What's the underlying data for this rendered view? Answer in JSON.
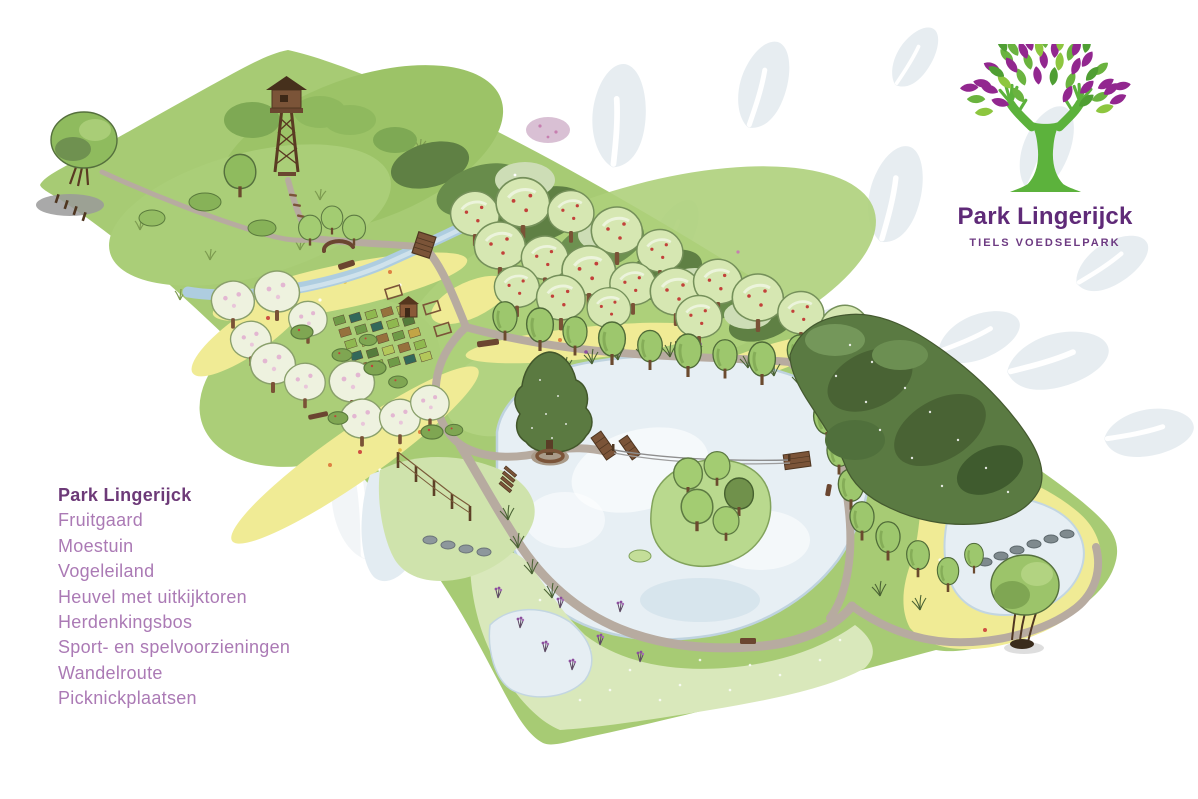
{
  "logo": {
    "name": "Park Lingerijck",
    "tagline": "TIELS VOEDSELPARK",
    "colors": {
      "trunk": "#5cb23c",
      "leaf_purple": "#92278f",
      "leaf_purple_dark": "#7b2482",
      "leaf_green": "#6ab33f",
      "leaf_green_light": "#8dc63f",
      "leaf_green_dark": "#4f9e33",
      "title_text": "#5f2a78"
    }
  },
  "legend": {
    "title": "Park Lingerijck",
    "title_color": "#6d3a78",
    "item_color": "#ab7ab5",
    "items": [
      "Fruitgaard",
      "Moestuin",
      "Vogeleiland",
      "Heuvel met uitkijktoren",
      "Herdenkingsbos",
      "Sport- en spelvoorzieningen",
      "Wandelroute",
      "Picknickplaatsen"
    ]
  },
  "map": {
    "palette": {
      "grass": "#a7cb74",
      "water": "#e7eff4",
      "path": "#b7aba0",
      "forest": "#5a7a42",
      "flower_yellow": "#f0eb95",
      "stream": "#aecde0",
      "marsh": "#d9e8bb",
      "watermark_leaf": "#e7edf1"
    }
  }
}
